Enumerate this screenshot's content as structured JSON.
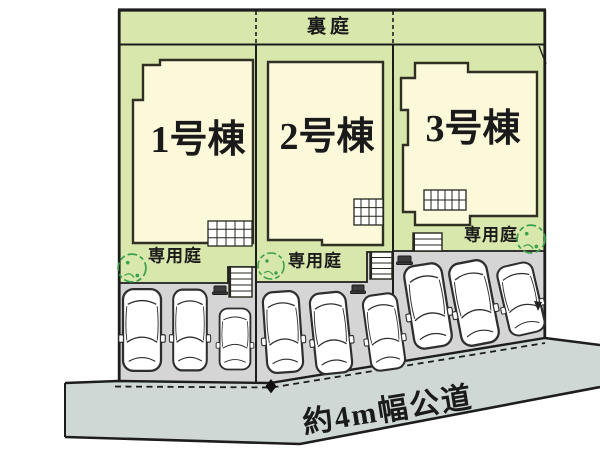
{
  "diagram": {
    "type": "residential-site-plan",
    "back_garden_label": "裏庭",
    "road_label": "約4m幅公道",
    "lots": [
      {
        "building_label": "1号棟",
        "garden_label": "専用庭",
        "parking_spaces": 3
      },
      {
        "building_label": "2号棟",
        "garden_label": "専用庭",
        "parking_spaces": 3
      },
      {
        "building_label": "3号棟",
        "garden_label": "専用庭",
        "parking_spaces": 3
      }
    ],
    "colors": {
      "lawn": "#d8e7ab",
      "building": "#fcf9da",
      "parking": "#d5d5d5",
      "road": "#cfd8d4",
      "outline": "#1d1d1d",
      "tree": "#3aa04d",
      "background": "#ffffff"
    }
  }
}
